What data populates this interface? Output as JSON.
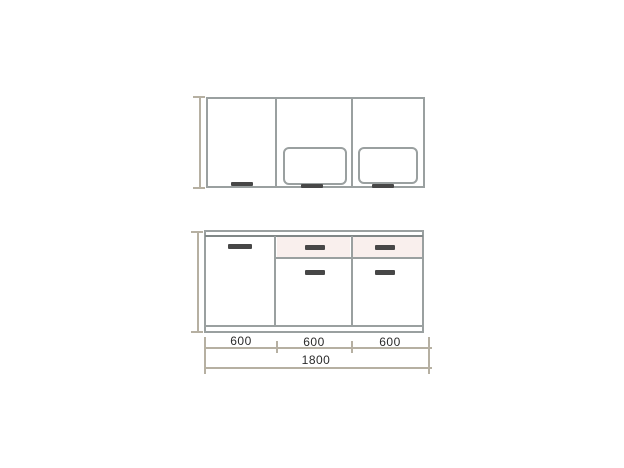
{
  "page": {
    "description": "Scanned elevation drawing of a kitchen unit, wall cabinets above and base cabinets below, total width 1800 mm"
  },
  "colors": {
    "line": "#9aa0a0",
    "line_dark": "#808787",
    "handle": "#474747",
    "drawer_tint": "#f9efed",
    "dim": "#b6b0a2",
    "text": "#2b2b2b",
    "paper": "#ffffff"
  },
  "upper_row": {
    "type": "wall-cabinets-elevation",
    "cabinets": [
      {
        "id": "wall-left",
        "front": "plain door with bottom handle"
      },
      {
        "id": "wall-middle",
        "front": "door with recessed rounded panel and bottom handle"
      },
      {
        "id": "wall-right",
        "front": "door with recessed rounded panel and bottom handle"
      }
    ]
  },
  "lower_row": {
    "type": "base-cabinets-elevation",
    "cabinets": [
      {
        "id": "base-left",
        "front": "full door, handle at top"
      },
      {
        "id": "base-middle",
        "front": "drawer over door"
      },
      {
        "id": "base-right",
        "front": "drawer over door"
      }
    ]
  },
  "dimensions": {
    "segment_labels": [
      "600",
      "600",
      "600"
    ],
    "total_label": "1800"
  }
}
